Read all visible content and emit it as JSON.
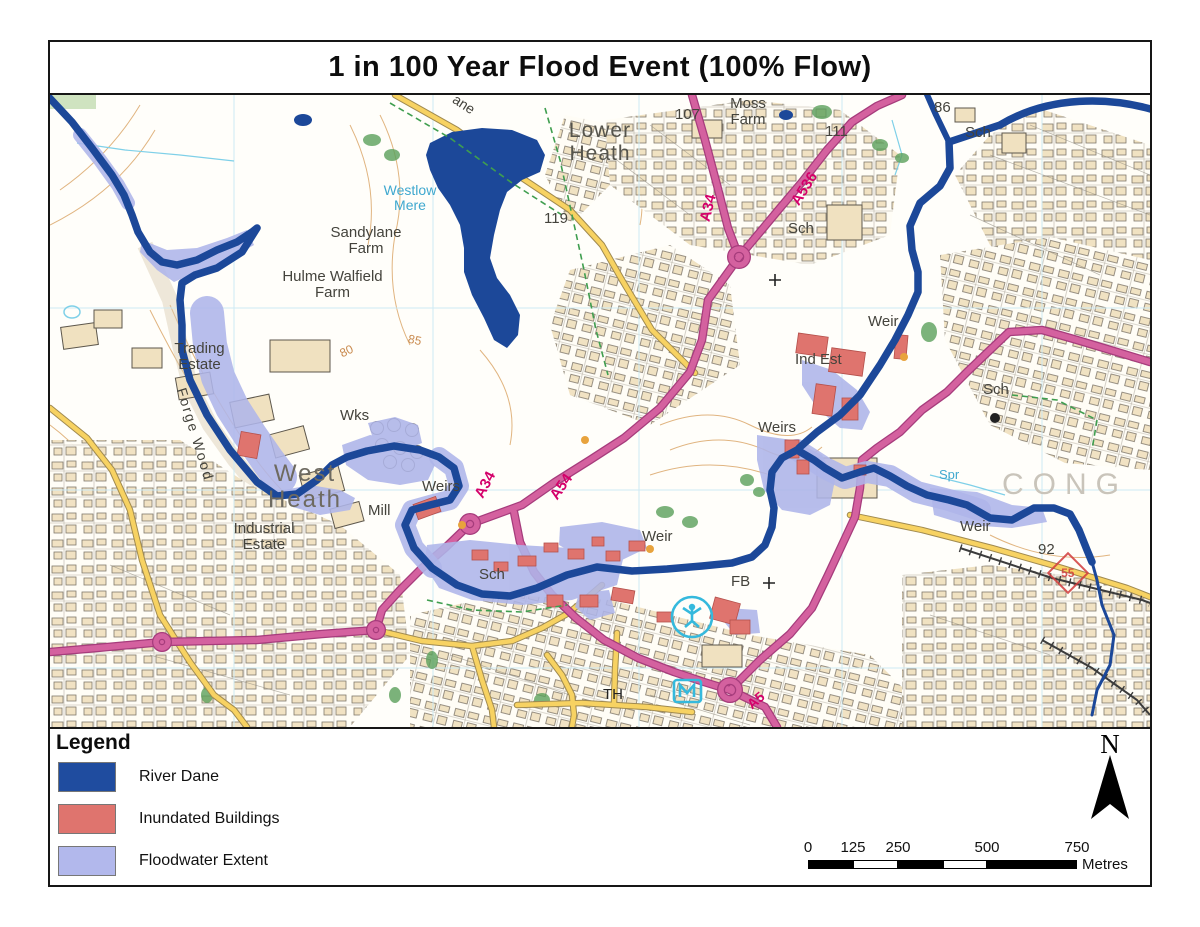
{
  "title": "1 in 100 Year Flood Event (100% Flow)",
  "legend": {
    "heading": "Legend",
    "items": [
      {
        "label": "River Dane",
        "color": "#1f4c9f"
      },
      {
        "label": "Inundated Buildings",
        "color": "#df746e"
      },
      {
        "label": "Floodwater Extent",
        "color": "#b2b8ec"
      }
    ]
  },
  "north_label": "N",
  "scale_bar": {
    "tick_labels": [
      "0",
      "125",
      "250",
      "500",
      "750"
    ],
    "unit": "Metres"
  },
  "colors": {
    "river": "#1c4899",
    "floodwater": "#aeb5e9",
    "inundated_building": "#df746e",
    "primary_road": "#d4619f",
    "minor_road": "#f7d262",
    "building_fill": "#f0e1c0"
  },
  "map": {
    "labels": [
      {
        "id": "lower-heath",
        "text": "Lower\nHeath"
      },
      {
        "id": "moss-farm",
        "text": "Moss\nFarm"
      },
      {
        "id": "spot-107",
        "text": "107"
      },
      {
        "id": "spot-86",
        "text": "86"
      },
      {
        "id": "sch-top",
        "text": "Sch"
      },
      {
        "id": "spot-111",
        "text": "111"
      },
      {
        "id": "sch-a536",
        "text": "Sch"
      },
      {
        "id": "road-a536",
        "text": "A536"
      },
      {
        "id": "road-a34-north",
        "text": "A34"
      },
      {
        "id": "lane-fragment",
        "text": "ane"
      },
      {
        "id": "westlow-mere",
        "text": "Westlow\nMere"
      },
      {
        "id": "spot-119",
        "text": "119"
      },
      {
        "id": "sandylane-farm",
        "text": "Sandylane\nFarm"
      },
      {
        "id": "hulme-walfield-farm",
        "text": "Hulme Walfield\nFarm"
      },
      {
        "id": "trading-estate",
        "text": "Trading\nEstate"
      },
      {
        "id": "forge-wood",
        "text": "Forge Wood"
      },
      {
        "id": "wks",
        "text": "Wks"
      },
      {
        "id": "west-heath",
        "text": "West\nHeath"
      },
      {
        "id": "mill",
        "text": "Mill"
      },
      {
        "id": "industrial-estate",
        "text": "Industrial\nEstate"
      },
      {
        "id": "weirs-center",
        "text": "Weirs"
      },
      {
        "id": "road-a34-center",
        "text": "A34"
      },
      {
        "id": "road-a54",
        "text": "A54"
      },
      {
        "id": "weir-center",
        "text": "Weir"
      },
      {
        "id": "fb",
        "text": "FB"
      },
      {
        "id": "sch-flood",
        "text": "Sch"
      },
      {
        "id": "weirs-right",
        "text": "Weirs"
      },
      {
        "id": "weir-topright",
        "text": "Weir"
      },
      {
        "id": "ind-est",
        "text": "Ind Est"
      },
      {
        "id": "sch-right",
        "text": "Sch"
      },
      {
        "id": "spr",
        "text": "Spr"
      },
      {
        "id": "congleton-fragment",
        "text": "CONG"
      },
      {
        "id": "weir-bottomright",
        "text": "Weir"
      },
      {
        "id": "spot-92",
        "text": "92"
      },
      {
        "id": "town-hall",
        "text": "TH"
      },
      {
        "id": "contour-80",
        "text": "80"
      },
      {
        "id": "contour-85",
        "text": "85"
      },
      {
        "id": "road-a5-fragment",
        "text": "A5"
      },
      {
        "id": "cycle-route-55",
        "text": "55"
      }
    ]
  }
}
